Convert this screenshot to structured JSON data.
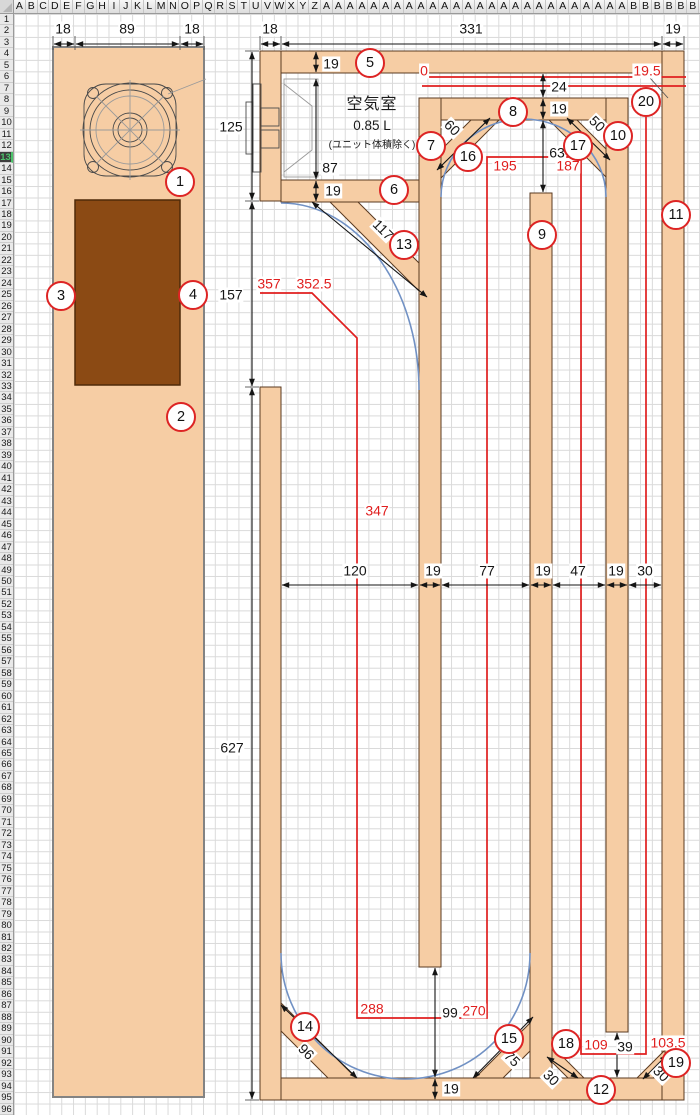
{
  "spreadsheet": {
    "column_letters": [
      "A",
      "B",
      "C",
      "D",
      "E",
      "F",
      "G",
      "H",
      "I",
      "J",
      "K",
      "L",
      "M",
      "N",
      "O",
      "P",
      "Q",
      "R",
      "S",
      "T",
      "U",
      "V",
      "W",
      "X",
      "Y",
      "Z",
      "A",
      "A",
      "A",
      "A",
      "A",
      "A",
      "A",
      "A",
      "A",
      "A",
      "A",
      "A",
      "A",
      "A",
      "A",
      "A",
      "A",
      "A",
      "A",
      "A",
      "A",
      "A",
      "A",
      "A",
      "A",
      "A",
      "B",
      "B",
      "B",
      "B",
      "B",
      "B"
    ],
    "row_count": 96,
    "active_row": 13
  },
  "air_chamber": {
    "title": "空気室",
    "volume": "0.85 L",
    "note": "(ユニット体積除く)"
  },
  "colors": {
    "panel_fill": "#f6cda4",
    "panel_border": "#5a3a20",
    "port_fill": "#8b4a14",
    "dim_red": "#e01f1f",
    "curve_blue": "#7191c4",
    "grid_line": "#dadada",
    "active_row_bg": "#3d3d3d",
    "active_row_text": "#4cc36a",
    "circle_red": "#dd2424"
  },
  "drawing": {
    "part_labels": [
      {
        "n": 1,
        "x": 180,
        "y": 182
      },
      {
        "n": 2,
        "x": 181,
        "y": 417
      },
      {
        "n": 3,
        "x": 61,
        "y": 296
      },
      {
        "n": 4,
        "x": 193,
        "y": 295
      },
      {
        "n": 5,
        "x": 370,
        "y": 63
      },
      {
        "n": 6,
        "x": 394,
        "y": 190
      },
      {
        "n": 7,
        "x": 431,
        "y": 146
      },
      {
        "n": 8,
        "x": 513,
        "y": 112
      },
      {
        "n": 9,
        "x": 542,
        "y": 235
      },
      {
        "n": 10,
        "x": 618,
        "y": 136
      },
      {
        "n": 11,
        "x": 676,
        "y": 215
      },
      {
        "n": 12,
        "x": 601,
        "y": 1090
      },
      {
        "n": 13,
        "x": 404,
        "y": 245
      },
      {
        "n": 14,
        "x": 305,
        "y": 1027
      },
      {
        "n": 15,
        "x": 509,
        "y": 1039
      },
      {
        "n": 16,
        "x": 468,
        "y": 157
      },
      {
        "n": 17,
        "x": 578,
        "y": 146
      },
      {
        "n": 18,
        "x": 566,
        "y": 1044
      },
      {
        "n": 19,
        "x": 676,
        "y": 1063
      },
      {
        "n": 20,
        "x": 646,
        "y": 102
      }
    ],
    "dimensions_black": [
      {
        "t": "18",
        "x": 63,
        "y": 29
      },
      {
        "t": "89",
        "x": 127,
        "y": 29
      },
      {
        "t": "18",
        "x": 192,
        "y": 29
      },
      {
        "t": "18",
        "x": 270,
        "y": 29
      },
      {
        "t": "331",
        "x": 471,
        "y": 29
      },
      {
        "t": "19",
        "x": 673,
        "y": 29
      },
      {
        "t": "125",
        "x": 231,
        "y": 127
      },
      {
        "t": "157",
        "x": 231,
        "y": 295
      },
      {
        "t": "627",
        "x": 232,
        "y": 748
      },
      {
        "t": "19",
        "x": 331,
        "y": 64
      },
      {
        "t": "87",
        "x": 330,
        "y": 168
      },
      {
        "t": "19",
        "x": 333,
        "y": 191
      },
      {
        "t": "24",
        "x": 559,
        "y": 87
      },
      {
        "t": "19",
        "x": 559,
        "y": 109
      },
      {
        "t": "63",
        "x": 557,
        "y": 153
      },
      {
        "t": "120",
        "x": 355,
        "y": 571
      },
      {
        "t": "19",
        "x": 433,
        "y": 571
      },
      {
        "t": "77",
        "x": 487,
        "y": 571
      },
      {
        "t": "19",
        "x": 543,
        "y": 571
      },
      {
        "t": "47",
        "x": 578,
        "y": 571
      },
      {
        "t": "19",
        "x": 616,
        "y": 571
      },
      {
        "t": "30",
        "x": 645,
        "y": 571
      },
      {
        "t": "99",
        "x": 450,
        "y": 1013
      },
      {
        "t": "19",
        "x": 451,
        "y": 1089
      },
      {
        "t": "39",
        "x": 625,
        "y": 1047
      },
      {
        "t": "117",
        "x": 383,
        "y": 230,
        "r": 45
      },
      {
        "t": "60",
        "x": 452,
        "y": 128,
        "r": 45
      },
      {
        "t": "50",
        "x": 597,
        "y": 124,
        "r": 45
      },
      {
        "t": "96",
        "x": 306,
        "y": 1052,
        "r": 45
      },
      {
        "t": "75",
        "x": 512,
        "y": 1059,
        "r": 45
      },
      {
        "t": "30",
        "x": 551,
        "y": 1078,
        "r": 45
      },
      {
        "t": "30",
        "x": 661,
        "y": 1074,
        "r": 45
      }
    ],
    "dimensions_red": [
      {
        "t": "0",
        "x": 424,
        "y": 71
      },
      {
        "t": "19.5",
        "x": 647,
        "y": 71
      },
      {
        "t": "357",
        "x": 269,
        "y": 284
      },
      {
        "t": "352.5",
        "x": 314,
        "y": 284
      },
      {
        "t": "347",
        "x": 377,
        "y": 511
      },
      {
        "t": "195",
        "x": 505,
        "y": 166
      },
      {
        "t": "187",
        "x": 568,
        "y": 166
      },
      {
        "t": "288",
        "x": 372,
        "y": 1009
      },
      {
        "t": "270",
        "x": 474,
        "y": 1011
      },
      {
        "t": "109",
        "x": 596,
        "y": 1045
      },
      {
        "t": "103.5",
        "x": 668,
        "y": 1043
      }
    ]
  }
}
